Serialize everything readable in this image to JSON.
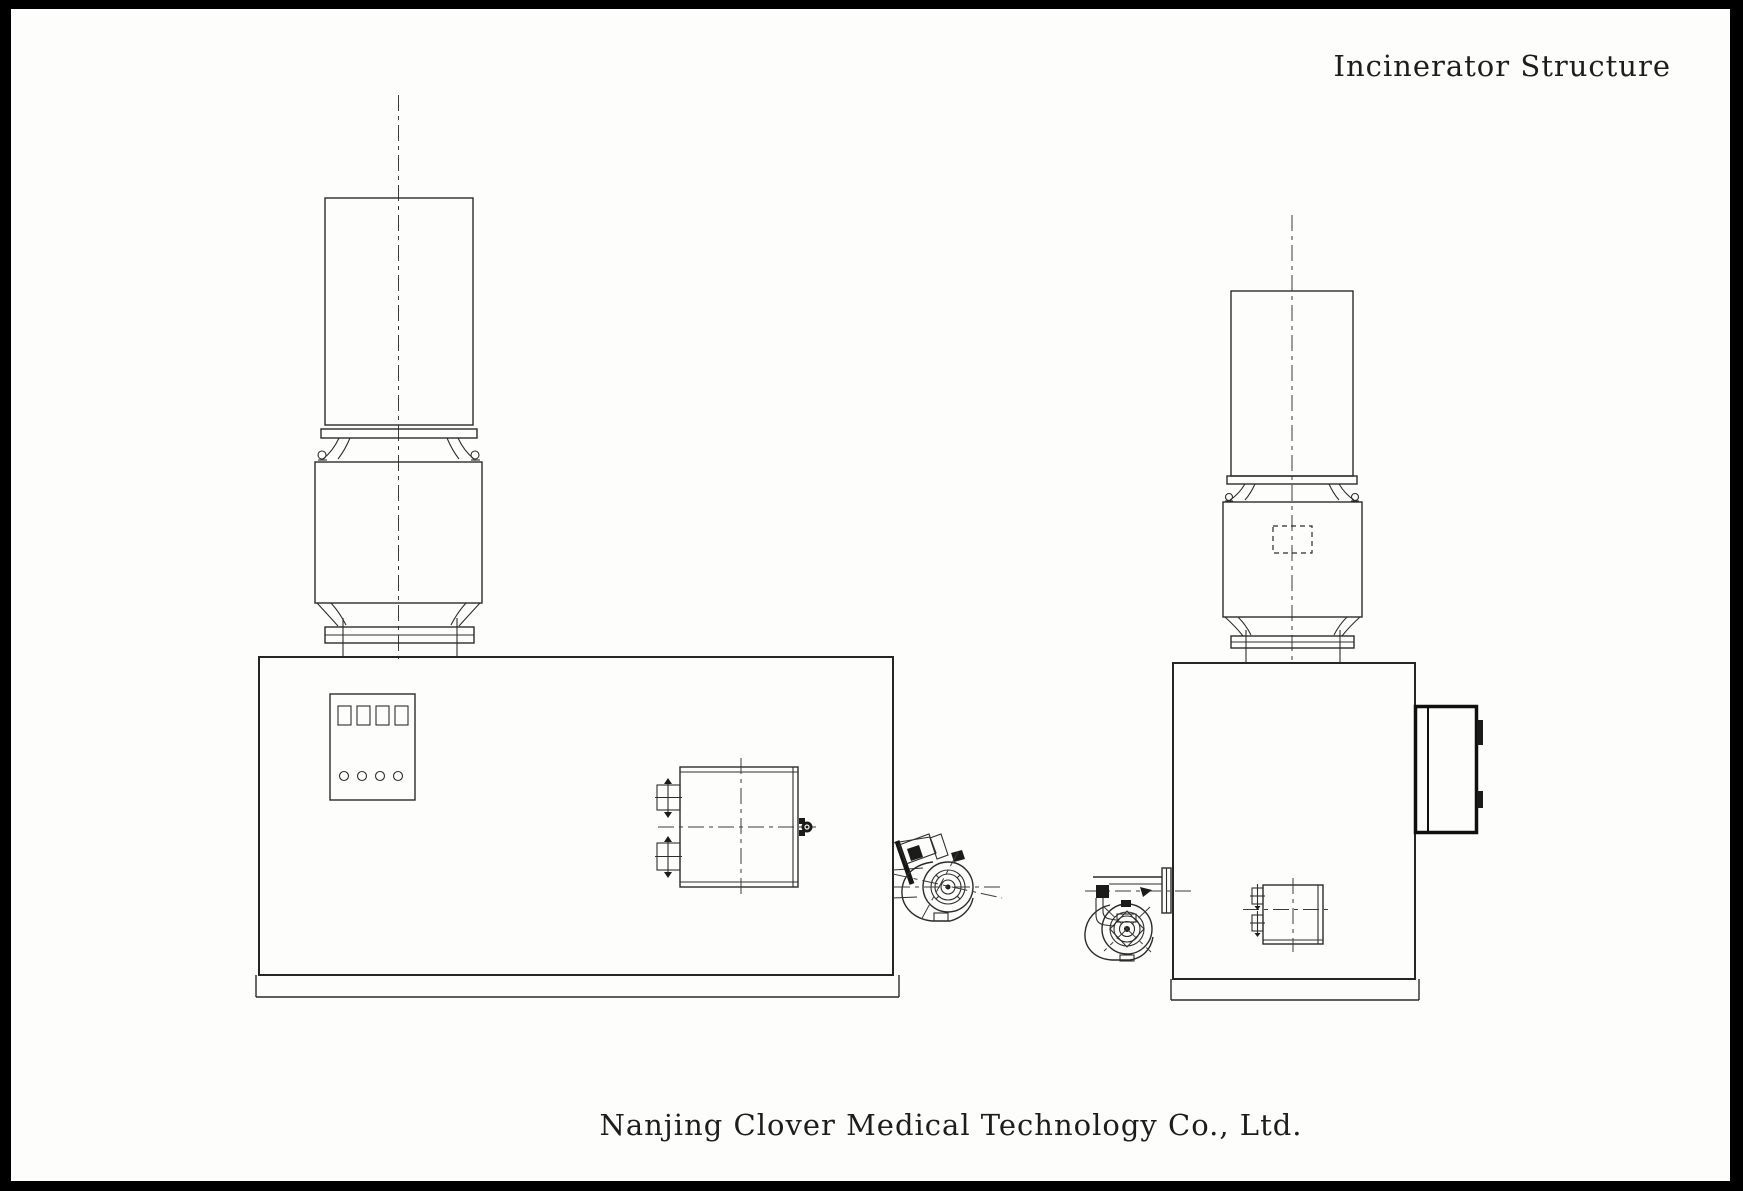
{
  "header": {
    "title": "Incinerator Structure"
  },
  "footer": {
    "company": "Nanjing Clover Medical Technology Co., Ltd."
  },
  "colors": {
    "frame": "#000000",
    "paper": "#fdfdfc",
    "ink": "#2b2b2b",
    "ink_heavy": "#101010"
  }
}
